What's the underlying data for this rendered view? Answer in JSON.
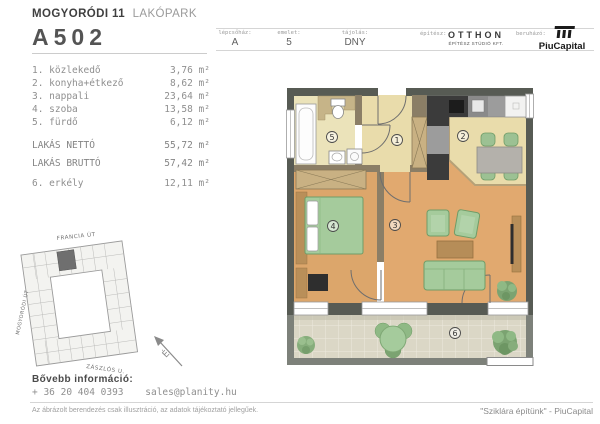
{
  "header": {
    "project_bold": "MOGYORÓDI 11",
    "project_light": "LAKÓPARK",
    "unit_id": "A502",
    "info": [
      {
        "label": "lépcsőház:",
        "value": "A"
      },
      {
        "label": "emelet:",
        "value": "5"
      },
      {
        "label": "tájolás:",
        "value": "DNY"
      }
    ],
    "architect_label": "építész:",
    "architect_name": "OTTHON",
    "architect_sub": "ÉPÍTÉSZ STÚDIÓ KFT.",
    "developer_label": "beruházó:",
    "developer_name": "PiuCapital"
  },
  "rooms": [
    {
      "name": "1. közlekedő",
      "area": "3,76 m²"
    },
    {
      "name": "2. konyha+étkező",
      "area": "8,62 m²"
    },
    {
      "name": "3. nappali",
      "area": "23,64 m²"
    },
    {
      "name": "4. szoba",
      "area": "13,58 m²"
    },
    {
      "name": "5. fürdő",
      "area": "6,12 m²"
    }
  ],
  "totals": [
    {
      "name": "LAKÁS NETTÓ",
      "area": "55,72 m²"
    },
    {
      "name": "LAKÁS BRUTTÓ",
      "area": "57,42 m²"
    }
  ],
  "balcony_row": {
    "name": "6. erkély",
    "area": "12,11 m²"
  },
  "floorplan": {
    "labels": [
      "1",
      "2",
      "3",
      "4",
      "5",
      "6"
    ]
  },
  "siteplan": {
    "streets": [
      "FRANCIA ÚT",
      "MOGYORÓDI ÚT",
      "ZÁSZLÓS U."
    ],
    "north": "É"
  },
  "footer": {
    "info_label": "Bővebb információ:",
    "phone": "+ 36 20 404 0393",
    "email": "sales@planity.hu",
    "disclaimer": "Az ábrázolt berendezés csak illusztráció, az adatok tájékoztató jellegűek.",
    "slogan": "\"Sziklára építünk\" - PiuCapital"
  },
  "colors": {
    "outer_wall": "#575b54",
    "partition": "#8b7e66",
    "wood_floor": "#e1a96f",
    "tile_floor": "#e9dcab",
    "furniture_green": "#a5cb9c",
    "balcony_floor": "#dbd7c6",
    "brand_dark": "#1a1a1a"
  }
}
